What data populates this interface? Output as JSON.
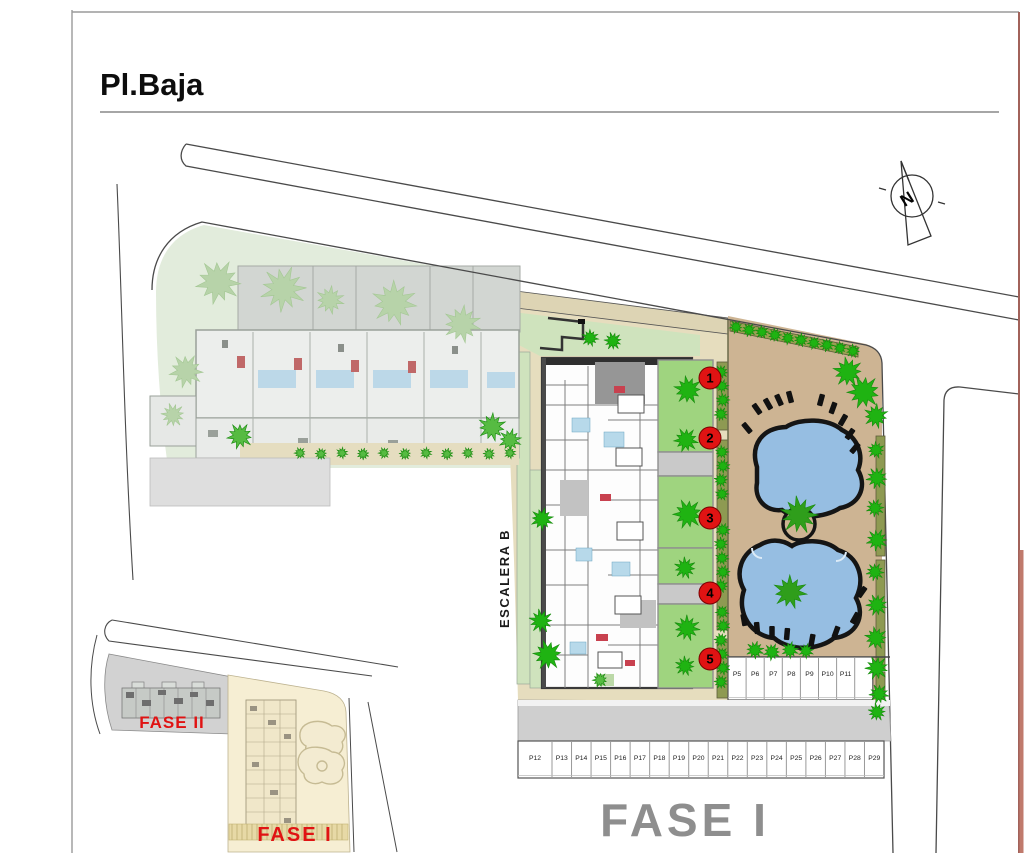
{
  "page": {
    "title": "Pl.Baja",
    "compass_letter": "N",
    "phase_label_main": "FASE I"
  },
  "plan": {
    "stair_label": "ESCALERA B",
    "unit_markers": [
      "1",
      "2",
      "3",
      "4",
      "5"
    ]
  },
  "parking": {
    "top_row": [
      "P5",
      "P6",
      "P7",
      "P8",
      "P9",
      "P10",
      "P11"
    ],
    "bottom_row": [
      "P12",
      "P13",
      "P14",
      "P15",
      "P16",
      "P17",
      "P18",
      "P19",
      "P20",
      "P21",
      "P22",
      "P23",
      "P24",
      "P25",
      "P26",
      "P27",
      "P28",
      "P29"
    ]
  },
  "inset": {
    "fase2_label": "FASE II",
    "fase1_label": "FASE I"
  },
  "colors": {
    "marker_red": "#e01313",
    "label_red": "#e01313",
    "phase_gray": "#8e8e8e",
    "pool_blue": "#96bee2",
    "deck_tan": "#cdb493",
    "lawn_green": "#cfe3bd",
    "tree_green": "#1fb312",
    "inset_yellow": "#f6eed3"
  }
}
